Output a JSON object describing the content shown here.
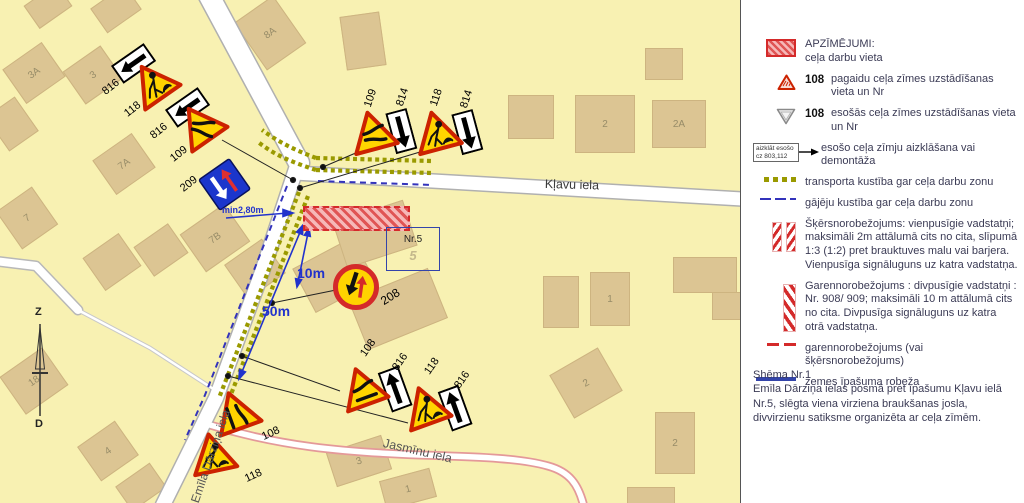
{
  "map": {
    "streets": {
      "klavu": "Kļavu iela",
      "jasminu": "Jasmīnu iela",
      "darzina": "Emīla Dārziņa iela"
    },
    "compass": {
      "north": "Z",
      "south": "D"
    },
    "annotations": {
      "min_width": "min2,80m",
      "dim_10": "10m",
      "dim_50": "50m"
    },
    "property": {
      "label": "Nr.5",
      "plot_number": "5"
    },
    "buildings": {
      "b3a": "3A",
      "b3": "3",
      "b8a": "8A",
      "b7a": "7A",
      "b7": "7",
      "b7b": "7B",
      "b18": "18",
      "b4": "4",
      "bj3": "3",
      "bj1": "1",
      "b2": "2",
      "b2a": "2A",
      "bs1": "1",
      "bs2": "2",
      "bs2b": "2"
    },
    "signs": {
      "s816": "816",
      "s814": "814",
      "s118": "118",
      "s109": "109",
      "s108": "108",
      "s209": "209",
      "s208": "208"
    }
  },
  "legend": {
    "title": "APZĪMĒJUMI:",
    "items": [
      {
        "icon": "work-zone-swatch",
        "text": "ceļa darbu vieta"
      },
      {
        "icon": "temp-sign-triangle",
        "nr": "108",
        "text": "pagaidu ceļa zīmes uzstādīšanas vieta un Nr"
      },
      {
        "icon": "existing-sign-triangle",
        "nr": "108",
        "text": "esošās ceļa zīmes uzstādīšanas vieta un Nr"
      },
      {
        "icon": "cover-box",
        "box_line1": "aizklāt esošo",
        "box_line2": "cz 803,112",
        "text": "esošo ceļa zīmju aizklāšana vai demontāža"
      },
      {
        "icon": "transport-dots",
        "text": "transporta kustība gar ceļa darbu zonu"
      },
      {
        "icon": "pedestrian-dashes",
        "text": "gājēju kustība gar ceļa darbu zonu"
      },
      {
        "icon": "cross-barrier-stripes",
        "text": "Šķērsnorobežojums: vienpusīgie vadstatņi; maksimāli 2m attālumā cits no cita, slīpumā 1:3 (1:2) pret brauktuves malu vai barjera. Vienpusīga signāluguns uz katra vadstatņa."
      },
      {
        "icon": "long-barrier-stripes",
        "text": "Garennorobežojums : divpusīgie vadstatņi : Nr. 908/ 909; maksimāli 10 m attālumā cits no cita. Divpusīga signāluguns uz katra otrā vadstatņa."
      },
      {
        "icon": "red-dashes",
        "text": "garennorobežojums (vai šķērsnorobežojums)"
      },
      {
        "icon": "blue-line",
        "text": "zemes īpašuma robeža"
      }
    ],
    "note": {
      "title": "Shēma Nr.1",
      "body": "Emīla Dārziņa ielas posmā pret īpašumu Kļavu ielā Nr.5, slēgta viena virziena braukšanas josla, divvirzienu satiksme organizēta ar ceļa zīmēm."
    }
  },
  "colors": {
    "map_bg": "#f8f1b2",
    "building": "#dcc593",
    "work_zone_red": "#d42a2a",
    "sign_border_red": "#cc2200",
    "sign_yellow": "#ffd400",
    "transport_olive": "#9a9a00",
    "pedestrian_blue": "#3333bb",
    "boundary_blue": "#3344aa",
    "dimension_blue": "#2233cc"
  }
}
